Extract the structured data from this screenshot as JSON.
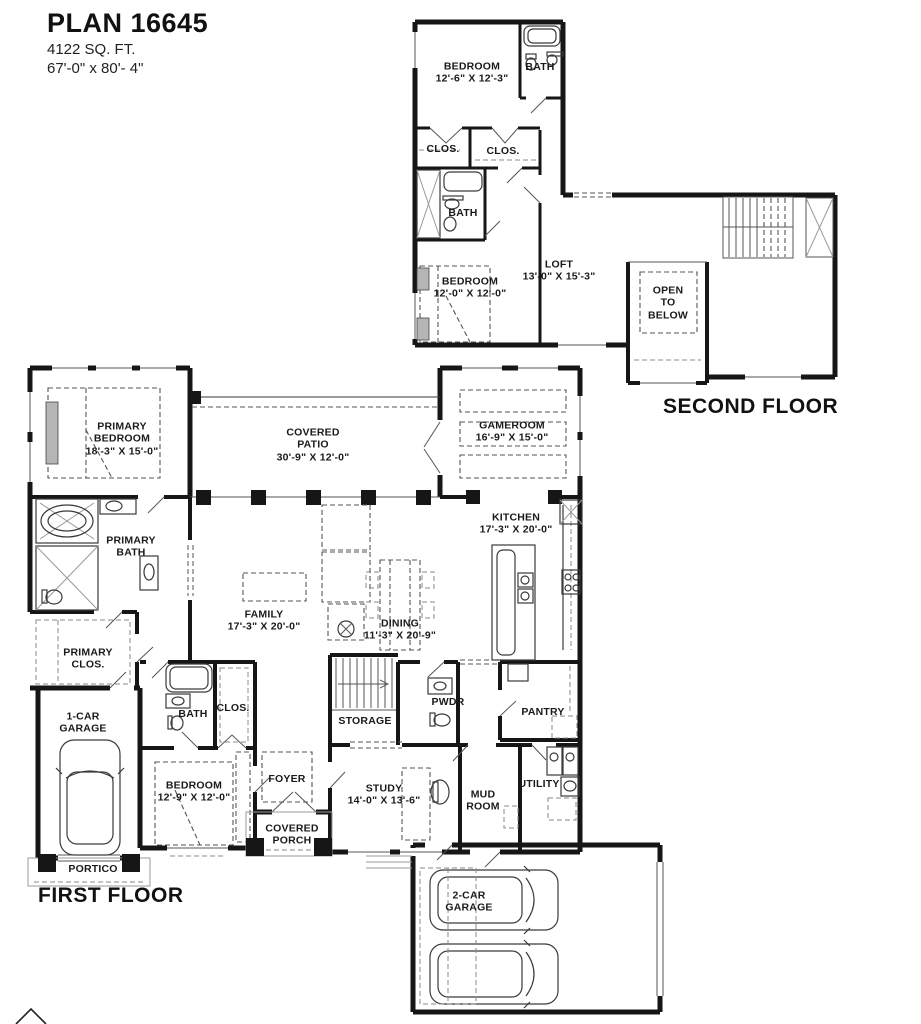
{
  "title": {
    "plan": "PLAN 16645",
    "sqft": "4122 SQ. FT.",
    "overall_dims": "67'-0\" x 80'- 4\""
  },
  "floor_labels": {
    "first": "FIRST FLOOR",
    "second": "SECOND FLOOR"
  },
  "colors": {
    "wall": "#161616",
    "thin_line": "#3a3a3a",
    "dashed_line": "#555555",
    "background": "#ffffff"
  },
  "rooms": [
    {
      "id": "bedroom-2f",
      "floor": "second",
      "name": "BEDROOM",
      "dims": "12'-6\" X 12'-3\"",
      "x": 472,
      "y": 73
    },
    {
      "id": "bath-2f-top",
      "floor": "second",
      "name": "BATH",
      "dims": "",
      "x": 540,
      "y": 67
    },
    {
      "id": "closet-2f-a",
      "floor": "second",
      "name": "CLOS.",
      "dims": "",
      "x": 443,
      "y": 149
    },
    {
      "id": "closet-2f-b",
      "floor": "second",
      "name": "CLOS.",
      "dims": "",
      "x": 503,
      "y": 151
    },
    {
      "id": "bath-2f-mid",
      "floor": "second",
      "name": "BATH",
      "dims": "",
      "x": 463,
      "y": 213
    },
    {
      "id": "bedroom-2f-mid",
      "floor": "second",
      "name": "BEDROOM",
      "dims": "12'-0\" X 12'-0\"",
      "x": 470,
      "y": 288
    },
    {
      "id": "loft",
      "floor": "second",
      "name": "LOFT",
      "dims": "13'-0\" X 15'-3\"",
      "x": 559,
      "y": 271
    },
    {
      "id": "open-to-below",
      "floor": "second",
      "name": "OPEN\nTO\nBELOW",
      "dims": "",
      "x": 668,
      "y": 303
    },
    {
      "id": "primary-bedroom",
      "floor": "first",
      "name": "PRIMARY\nBEDROOM",
      "dims": "18'-3\" X 15'-0\"",
      "x": 122,
      "y": 439
    },
    {
      "id": "covered-patio",
      "floor": "first",
      "name": "COVERED\nPATIO",
      "dims": "30'-9\" X 12'-0\"",
      "x": 313,
      "y": 445
    },
    {
      "id": "gameroom",
      "floor": "first",
      "name": "GAMEROOM",
      "dims": "16'-9\" X 15'-0\"",
      "x": 512,
      "y": 432
    },
    {
      "id": "kitchen",
      "floor": "first",
      "name": "KITCHEN",
      "dims": "17'-3\" X 20'-0\"",
      "x": 516,
      "y": 524
    },
    {
      "id": "family",
      "floor": "first",
      "name": "FAMILY",
      "dims": "17'-3\" X 20'-0\"",
      "x": 264,
      "y": 621
    },
    {
      "id": "dining",
      "floor": "first",
      "name": "DINING",
      "dims": "11'-3\" X 20'-9\"",
      "x": 400,
      "y": 630
    },
    {
      "id": "primary-bath",
      "floor": "first",
      "name": "PRIMARY\nBATH",
      "dims": "",
      "x": 131,
      "y": 547
    },
    {
      "id": "primary-closet",
      "floor": "first",
      "name": "PRIMARY\nCLOS.",
      "dims": "",
      "x": 88,
      "y": 659
    },
    {
      "id": "one-car-garage",
      "floor": "first",
      "name": "1-CAR\nGARAGE",
      "dims": "",
      "x": 83,
      "y": 723
    },
    {
      "id": "portico",
      "floor": "first",
      "name": "PORTICO",
      "dims": "",
      "x": 93,
      "y": 869
    },
    {
      "id": "bath-1f",
      "floor": "first",
      "name": "BATH",
      "dims": "",
      "x": 193,
      "y": 714
    },
    {
      "id": "closet-1f",
      "floor": "first",
      "name": "CLOS.",
      "dims": "",
      "x": 233,
      "y": 708
    },
    {
      "id": "bedroom-1f",
      "floor": "first",
      "name": "BEDROOM",
      "dims": "12'-9\" X 12'-0\"",
      "x": 194,
      "y": 792
    },
    {
      "id": "foyer",
      "floor": "first",
      "name": "FOYER",
      "dims": "",
      "x": 287,
      "y": 779
    },
    {
      "id": "covered-porch",
      "floor": "first",
      "name": "COVERED\nPORCH",
      "dims": "",
      "x": 292,
      "y": 835
    },
    {
      "id": "storage",
      "floor": "first",
      "name": "STORAGE",
      "dims": "",
      "x": 365,
      "y": 721
    },
    {
      "id": "powder",
      "floor": "first",
      "name": "PWDR",
      "dims": "",
      "x": 448,
      "y": 702
    },
    {
      "id": "pantry",
      "floor": "first",
      "name": "PANTRY",
      "dims": "",
      "x": 543,
      "y": 712
    },
    {
      "id": "study",
      "floor": "first",
      "name": "STUDY",
      "dims": "14'-0\" X 13'-6\"",
      "x": 384,
      "y": 795
    },
    {
      "id": "mud-room",
      "floor": "first",
      "name": "MUD\nROOM",
      "dims": "",
      "x": 483,
      "y": 801
    },
    {
      "id": "utility",
      "floor": "first",
      "name": "UTILITY",
      "dims": "",
      "x": 539,
      "y": 784
    },
    {
      "id": "two-car-garage",
      "floor": "first",
      "name": "2-CAR\nGARAGE",
      "dims": "",
      "x": 469,
      "y": 902
    }
  ]
}
